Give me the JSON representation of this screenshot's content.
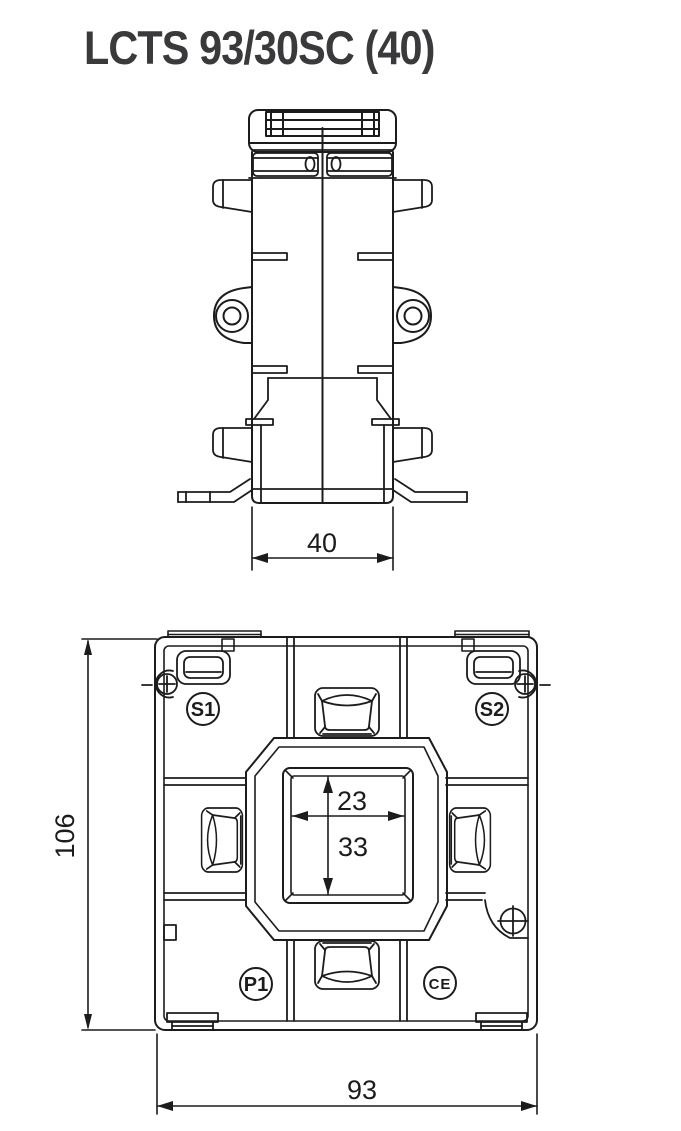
{
  "title": "LCTS 93/30SC (40)",
  "side_view": {
    "label": "side view drawing",
    "dim_width": "40"
  },
  "front_view": {
    "label": "front view drawing",
    "dim_height": "106",
    "dim_width": "93",
    "dim_window_width": "23",
    "dim_window_height": "33",
    "terminals": {
      "s1": "S1",
      "s2": "S2",
      "p1": "P1"
    },
    "ce_mark": "CE"
  },
  "colors": {
    "line": "#1c1c1c",
    "background": "#ffffff",
    "title_text": "#3a3a3c"
  }
}
